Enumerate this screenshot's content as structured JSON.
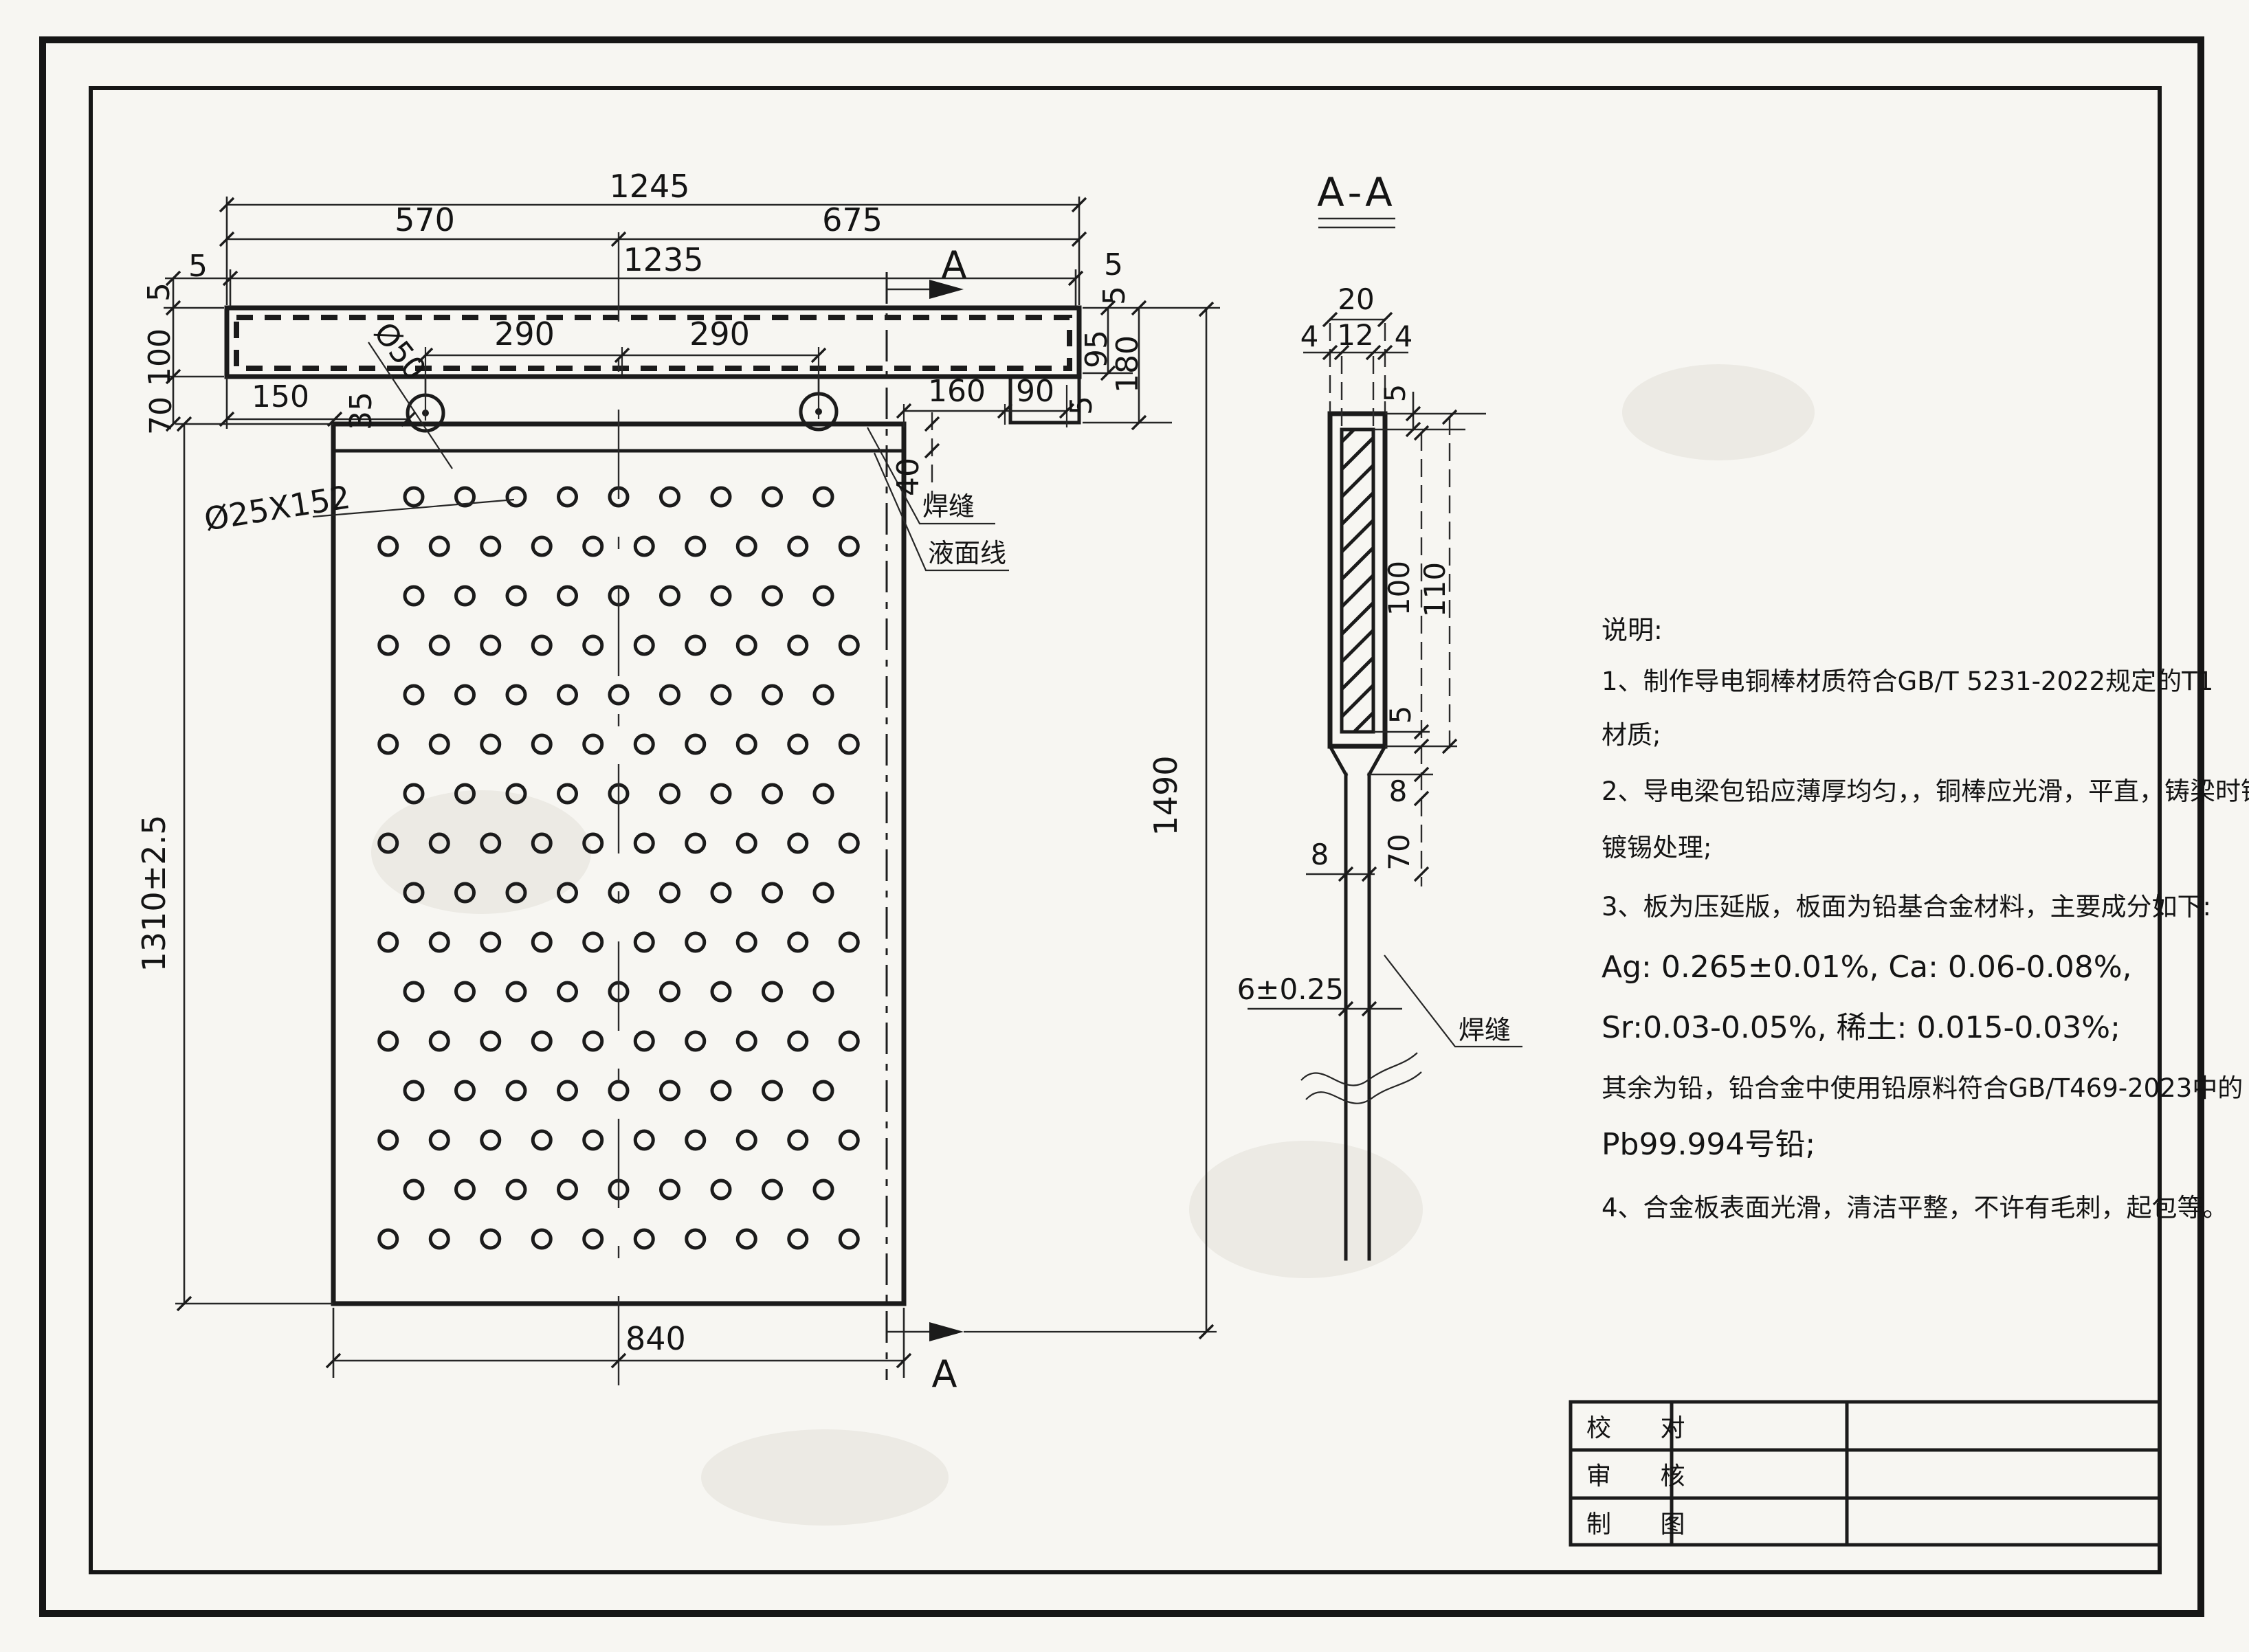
{
  "plan": {
    "dims": {
      "total_width": "1245",
      "span_left": "570",
      "span_right": "675",
      "inner_width": "1235",
      "gap_tl": "5",
      "gap_tr": "5",
      "side_l_top": "5",
      "side_r_top": "5",
      "bar_height": "100",
      "bar_to_plate": "70",
      "bar_left_to_plate": "150",
      "plate_to_lug": "35",
      "lug_dia": "Ø50",
      "lug_pitch_l": "290",
      "lug_pitch_r": "290",
      "right_edge_to_step": "160",
      "step_width": "90",
      "step_gap": "5",
      "end_height": "95",
      "end_total_height": "180",
      "weld_band": "40",
      "hole_spec": "Ø25X152",
      "plate_height": "1310±2.5",
      "overall_height": "1490",
      "plate_width": "840"
    },
    "labels": {
      "weld": "焊缝",
      "liquid_level": "液面线",
      "section": "A"
    },
    "holes": {
      "rows": 16,
      "per_row_a": 9,
      "per_row_b": 10,
      "total": 152
    }
  },
  "section": {
    "title": "A-A",
    "dims": {
      "outer_w": "20",
      "core_w": "12",
      "cover_l": "4",
      "cover_r": "4",
      "cover_top": "5",
      "core_h": "100",
      "outer_h": "110",
      "cover_bot": "5",
      "taper": "8",
      "taper_len": "70",
      "stem_w": "8",
      "plate_t": "6±0.25"
    },
    "labels": {
      "weld": "焊缝"
    }
  },
  "notes": {
    "heading": "说明:",
    "lines": [
      "1、制作导电铜棒材质符合GB/T 5231-2022规定的T1",
      "材质;",
      "2、导电梁包铅应薄厚均匀，，铜棒应光滑，平直，铸梁时铜表面应",
      "镀锡处理;",
      "3、板为压延版，板面为铅基合金材料，主要成分如下:",
      "Ag: 0.265±0.01%, Ca: 0.06-0.08%,",
      "Sr:0.03-0.05%, 稀土: 0.015-0.03%;",
      "其余为铅，铅合金中使用铅原料符合GB/T469-2023中的",
      "Pb99.994号铅;",
      "4、合金板表面光滑，清洁平整，不许有毛刺，起包等。"
    ]
  },
  "title_block": {
    "rows": [
      "校 对",
      "审 核",
      "制 图"
    ]
  }
}
